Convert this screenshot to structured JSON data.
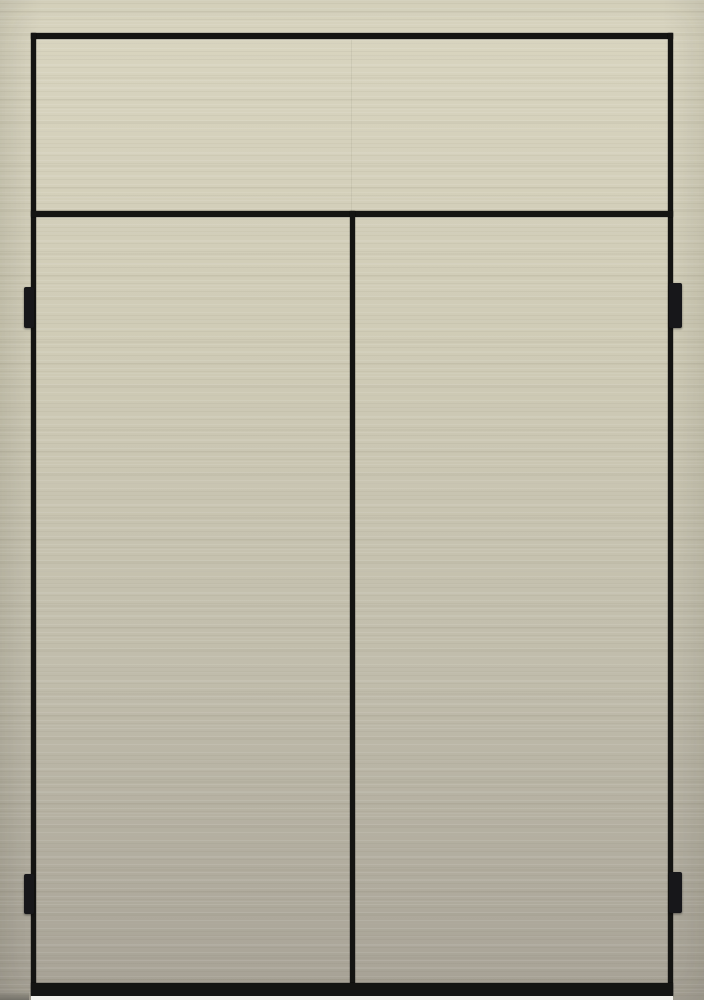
{
  "image": {
    "type": "photograph",
    "subject": "Front view of a cream textured cabinet with a full-width top drawer front, two doors below, black reveal gaps, black bottom band and four black edge hinges"
  },
  "colors": {
    "surface_top": "#d9d5c0",
    "surface_upper_mid": "#cfcbb6",
    "surface_lower_mid": "#c0bcab",
    "surface_bottom": "#a7a296",
    "gap": "#141412",
    "hinge": "#17171a",
    "floor": "#f2f1ec",
    "floor_shadow": "#6d6b63"
  },
  "parts": {
    "drawer_front": "top drawer front panel",
    "left_door": "left door",
    "right_door": "right door",
    "hinge_left_top": "upper left hinge",
    "hinge_left_bottom": "lower left hinge",
    "hinge_right_top": "upper right hinge",
    "hinge_right_bottom": "lower right hinge"
  }
}
